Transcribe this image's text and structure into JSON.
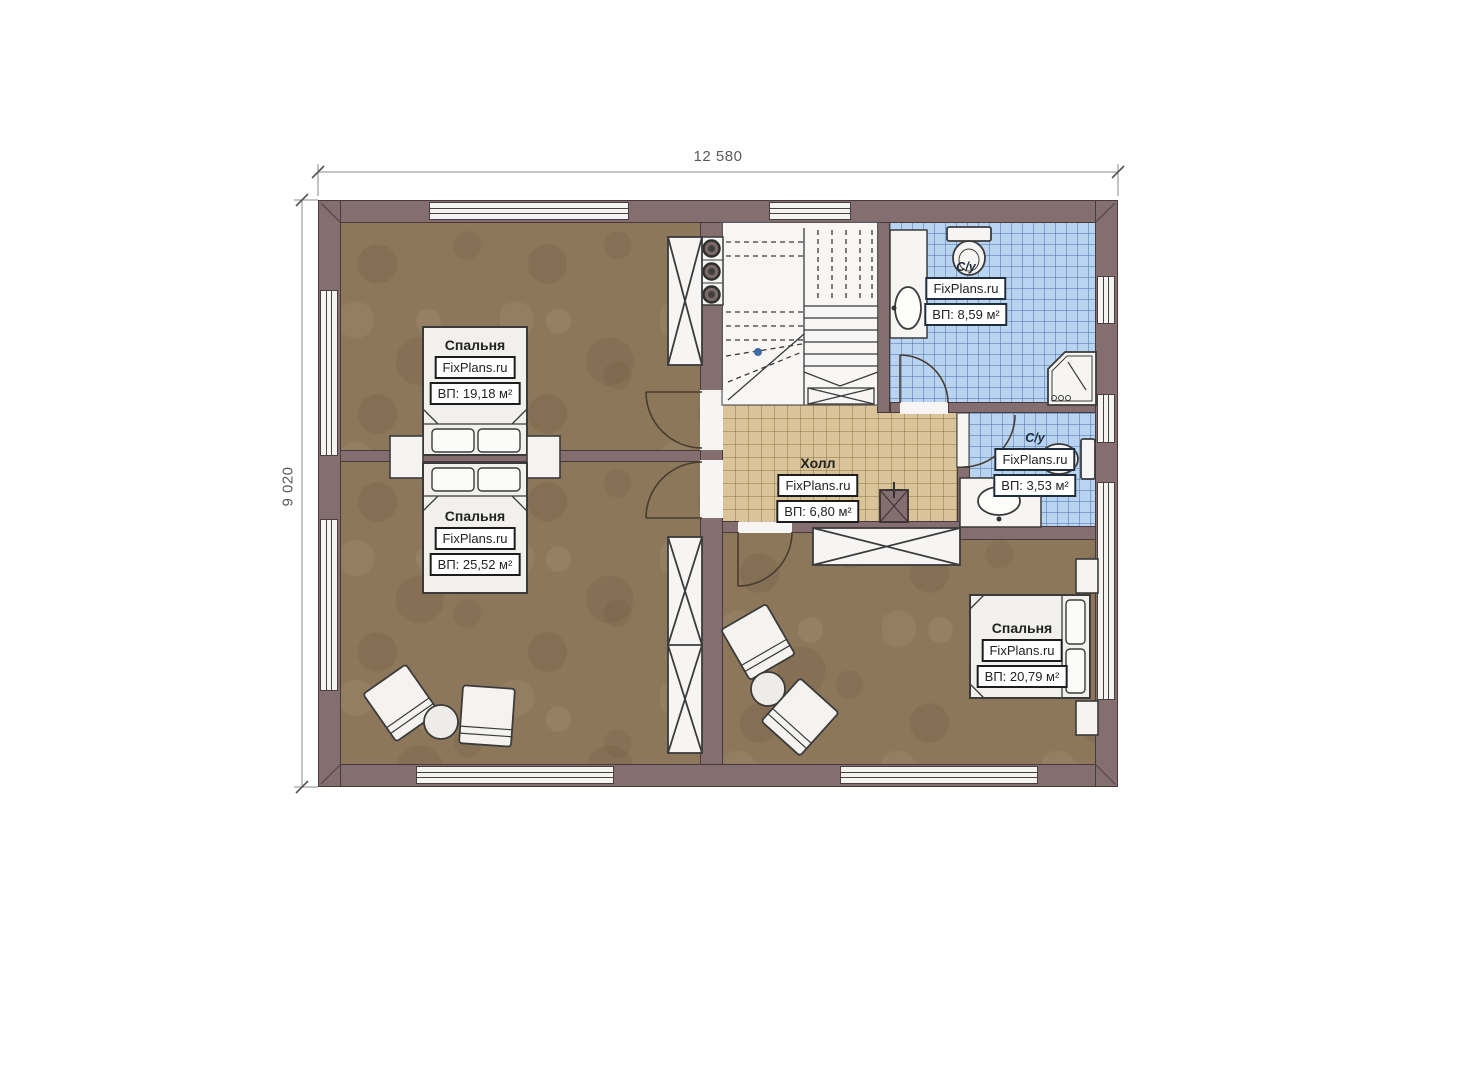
{
  "plan": {
    "dimensions": {
      "width_mm": "12 580",
      "height_mm": "9 020"
    },
    "rooms": [
      {
        "name": "Спальня",
        "watermark": "FixPlans.ru",
        "area": "ВП: 19,18 м²"
      },
      {
        "name": "Спальня",
        "watermark": "FixPlans.ru",
        "area": "ВП: 25,52 м²"
      },
      {
        "name": "Спальня",
        "watermark": "FixPlans.ru",
        "area": "ВП: 20,79 м²"
      },
      {
        "name": "Холл",
        "watermark": "FixPlans.ru",
        "area": "ВП: 6,80 м²"
      },
      {
        "name": "С/у",
        "watermark": "FixPlans.ru",
        "area": "ВП: 8,59 м²"
      },
      {
        "name": "С/у",
        "watermark": "FixPlans.ru",
        "area": "ВП: 3,53 м²"
      }
    ],
    "fixtures": [
      "staircase",
      "chimney-flues",
      "wardrobe",
      "bed",
      "nightstand",
      "armchair",
      "coffee-table",
      "toilet",
      "sink",
      "shower",
      "chimney-block",
      "door"
    ],
    "colors": {
      "wall": "#846e70",
      "wall_outline": "#463a3c",
      "wood_floor": "#8d775b",
      "hall_tile": "#d9c398",
      "bath_tile": "#b9d4f0",
      "dimension_text": "#5a5a5a"
    }
  }
}
